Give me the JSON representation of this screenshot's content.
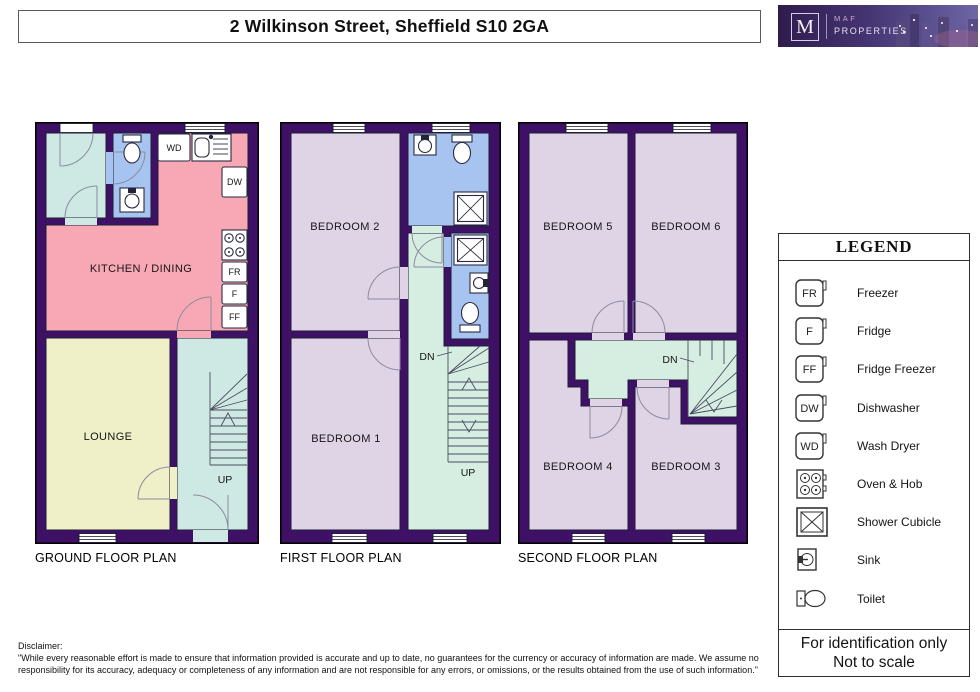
{
  "header": {
    "title": "2 Wilkinson Street, Sheffield S10 2GA",
    "logo": {
      "letter": "M",
      "brand_top": "MAF",
      "brand_bottom": "PROPERTIES"
    }
  },
  "plans": {
    "ground": {
      "title": "GROUND FLOOR PLAN",
      "rooms": {
        "kitchen": "KITCHEN / DINING",
        "lounge": "LOUNGE"
      },
      "stairs_up_label": "UP",
      "appliances": {
        "wd": "WD",
        "dw": "DW",
        "fr": "FR",
        "f": "F",
        "ff": "FF"
      }
    },
    "first": {
      "title": "FIRST FLOOR PLAN",
      "rooms": {
        "bedroom2": "BEDROOM 2",
        "bedroom1": "BEDROOM 1"
      },
      "stairs_down_label": "DN",
      "stairs_up_label": "UP"
    },
    "second": {
      "title": "SECOND FLOOR PLAN",
      "rooms": {
        "bedroom5": "BEDROOM 5",
        "bedroom6": "BEDROOM 6",
        "bedroom4": "BEDROOM 4",
        "bedroom3": "BEDROOM 3"
      },
      "stairs_down_label": "DN"
    }
  },
  "legend": {
    "title": "LEGEND",
    "items": [
      {
        "abbr": "FR",
        "label": "Freezer",
        "icon": "freezer-icon"
      },
      {
        "abbr": "F",
        "label": "Fridge",
        "icon": "fridge-icon"
      },
      {
        "abbr": "FF",
        "label": "Fridge Freezer",
        "icon": "fridge-freezer-icon"
      },
      {
        "abbr": "DW",
        "label": "Dishwasher",
        "icon": "dishwasher-icon"
      },
      {
        "abbr": "WD",
        "label": "Wash Dryer",
        "icon": "wash-dryer-icon"
      },
      {
        "abbr": "",
        "label": "Oven & Hob",
        "icon": "oven-hob-icon"
      },
      {
        "abbr": "",
        "label": "Shower Cubicle",
        "icon": "shower-cubicle-icon"
      },
      {
        "abbr": "",
        "label": "Sink",
        "icon": "sink-icon"
      },
      {
        "abbr": "",
        "label": "Toilet",
        "icon": "toilet-icon"
      }
    ],
    "footer_line1": "For identification only",
    "footer_line2": "Not to scale"
  },
  "disclaimer": {
    "label": "Disclaimer:",
    "text": "\"While every reasonable effort is made to ensure that information provided is accurate and up to date, no guarantees for the currency or accuracy of information are made. We assume no responsibility for its accuracy, adequacy or completeness of any information and are not responsible for any errors, or omissions, or the results obtained from the use of such information.\""
  },
  "colors": {
    "wall": "#3F1166",
    "kitchen": "#F7A8B4",
    "lounge": "#EFEFC8",
    "hall": "#CEE9E3",
    "bathroom": "#A6C4EF",
    "bedroom": "#DFD3E6",
    "landing": "#D6EEE2"
  }
}
